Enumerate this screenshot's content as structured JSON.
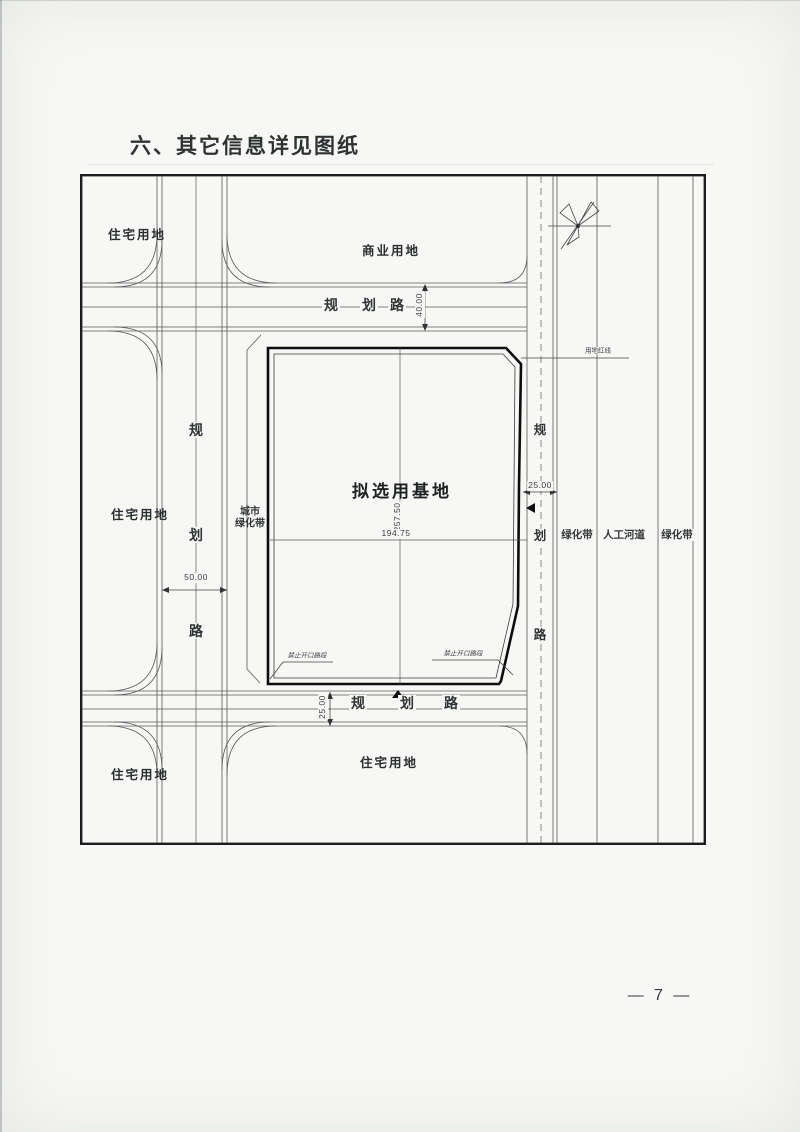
{
  "page": {
    "title": "六、其它信息详见图纸",
    "page_number": "— 7 —"
  },
  "map": {
    "site_label": "拟选用基地",
    "blocks": {
      "residential_top_left": "住宅用地",
      "commercial_top": "商业用地",
      "residential_mid_left": "住宅用地",
      "residential_bottom_left": "住宅用地",
      "residential_bottom_center": "住宅用地"
    },
    "green": {
      "city_belt_line1": "城市",
      "city_belt_line2": "绿化带",
      "belt_left": "绿化带",
      "river": "人工河道",
      "belt_right": "绿化带"
    },
    "roads": {
      "char1": "规",
      "char2": "划",
      "char3": "路"
    },
    "dims": {
      "top_road": "40.00",
      "left_road": "50.00",
      "right_road": "25.00",
      "bottom_road": "25.00",
      "site_height": "257.50",
      "site_width": "194.75"
    },
    "notes": {
      "red_line": "用地红线",
      "no_open_left": "禁止开口路段",
      "no_open_right": "禁止开口路段"
    },
    "icons": {
      "compass": "north-compass-icon",
      "entrance_marker_south": "triangle-up-arrow",
      "entrance_marker_east": "triangle-left-arrow"
    },
    "colors": {
      "paper": "#f7f8f5",
      "line": "#5a5a5a",
      "site_boundary": "#0d0d0d"
    }
  }
}
